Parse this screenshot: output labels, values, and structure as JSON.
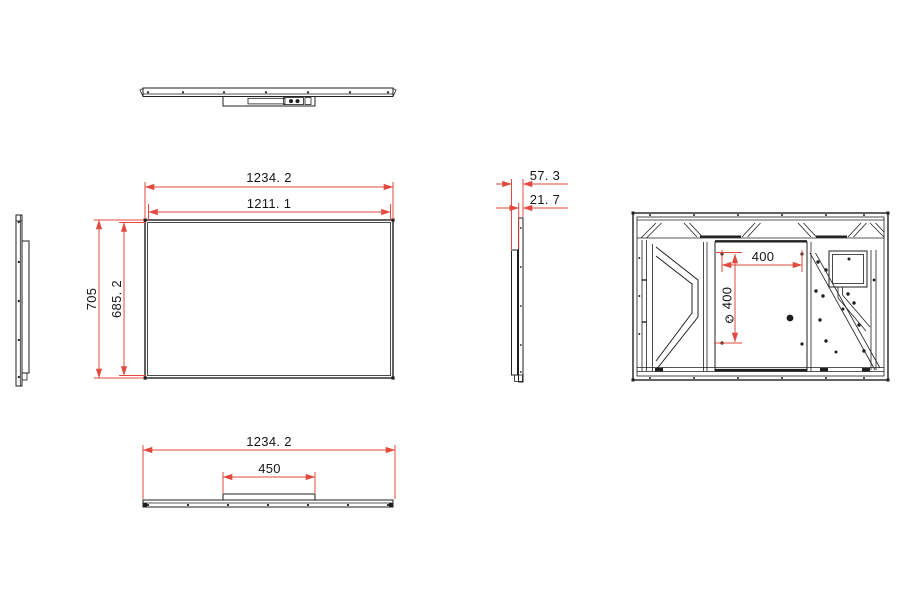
{
  "colors": {
    "dimension": "#e2493f",
    "line": "#1f1f1f",
    "background": "#ffffff"
  },
  "views": {
    "front": {
      "outer_width": "1234. 2",
      "inner_width": "1211. 1",
      "outer_height": "705",
      "inner_height": "685. 2"
    },
    "side": {
      "total_depth": "57. 3",
      "front_depth": "21. 7"
    },
    "back": {
      "vesa_horizontal": "400",
      "vesa_vertical": "400"
    },
    "bottom": {
      "outer_width": "1234. 2",
      "stand_width": "450"
    }
  }
}
